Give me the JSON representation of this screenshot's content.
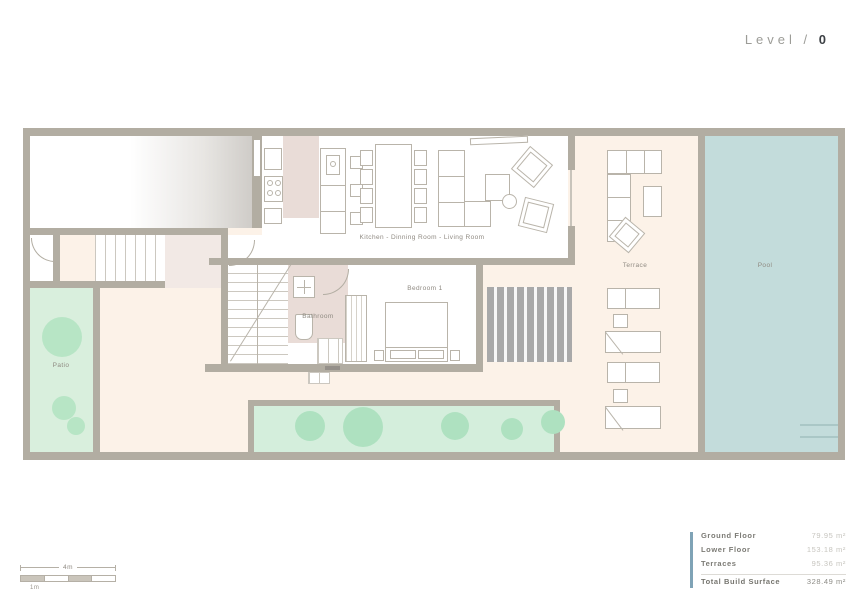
{
  "title": {
    "prefix": "Level /",
    "number": "0"
  },
  "plan_labels": {
    "main_room": "Kitchen - Dinning Room - Living Room",
    "bedroom": "Bedroom 1",
    "bathroom": "Bathroom",
    "terrace": "Terrace",
    "pool": "Pool",
    "patio": "Patio"
  },
  "scale_bar": {
    "total_label": "4m",
    "unit_label": "1m"
  },
  "area_table": {
    "rows": [
      {
        "label": "Ground Floor",
        "value": "79.95 m²"
      },
      {
        "label": "Lower Floor",
        "value": "153.18 m²"
      },
      {
        "label": "Terraces",
        "value": "95.36 m²"
      }
    ],
    "total": {
      "label": "Total Build Surface",
      "value": "328.49 m²"
    }
  },
  "colors": {
    "accent_bar": "#7fa3b6",
    "wall": "#b2ada2",
    "pool": "#c3dcdb",
    "patio_green": "#d9efdd",
    "terrace_cream": "#fcf2e8",
    "interior_pink": "#e9dcd7"
  }
}
